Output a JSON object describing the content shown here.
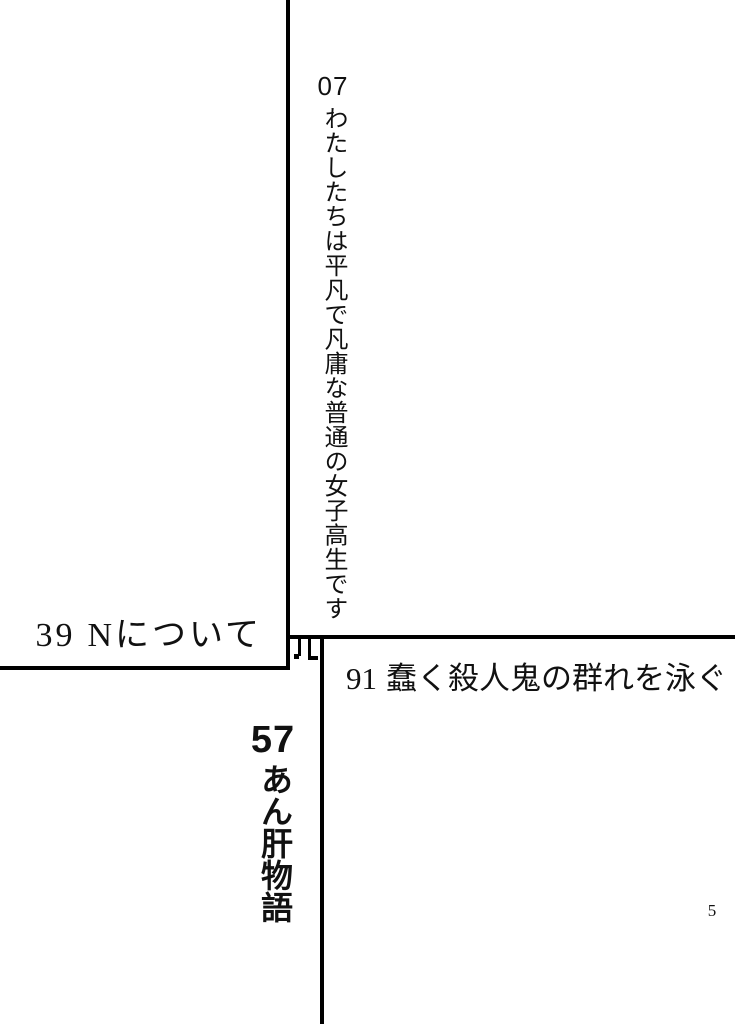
{
  "page": {
    "kind": "table-of-contents",
    "page_number": "5",
    "background_color": "#ffffff",
    "ink_color": "#111111",
    "rule_color": "#000000",
    "junction_character": "四"
  },
  "toc": {
    "entries": [
      {
        "page": "07",
        "title": "わたしたちは平凡で凡庸な普通の女子高生です"
      },
      {
        "page": "39",
        "title": "Nについて"
      },
      {
        "page": "57",
        "title": "あん肝物語"
      },
      {
        "page": "91",
        "title": "蠢く殺人鬼の群れを泳ぐ"
      }
    ]
  }
}
